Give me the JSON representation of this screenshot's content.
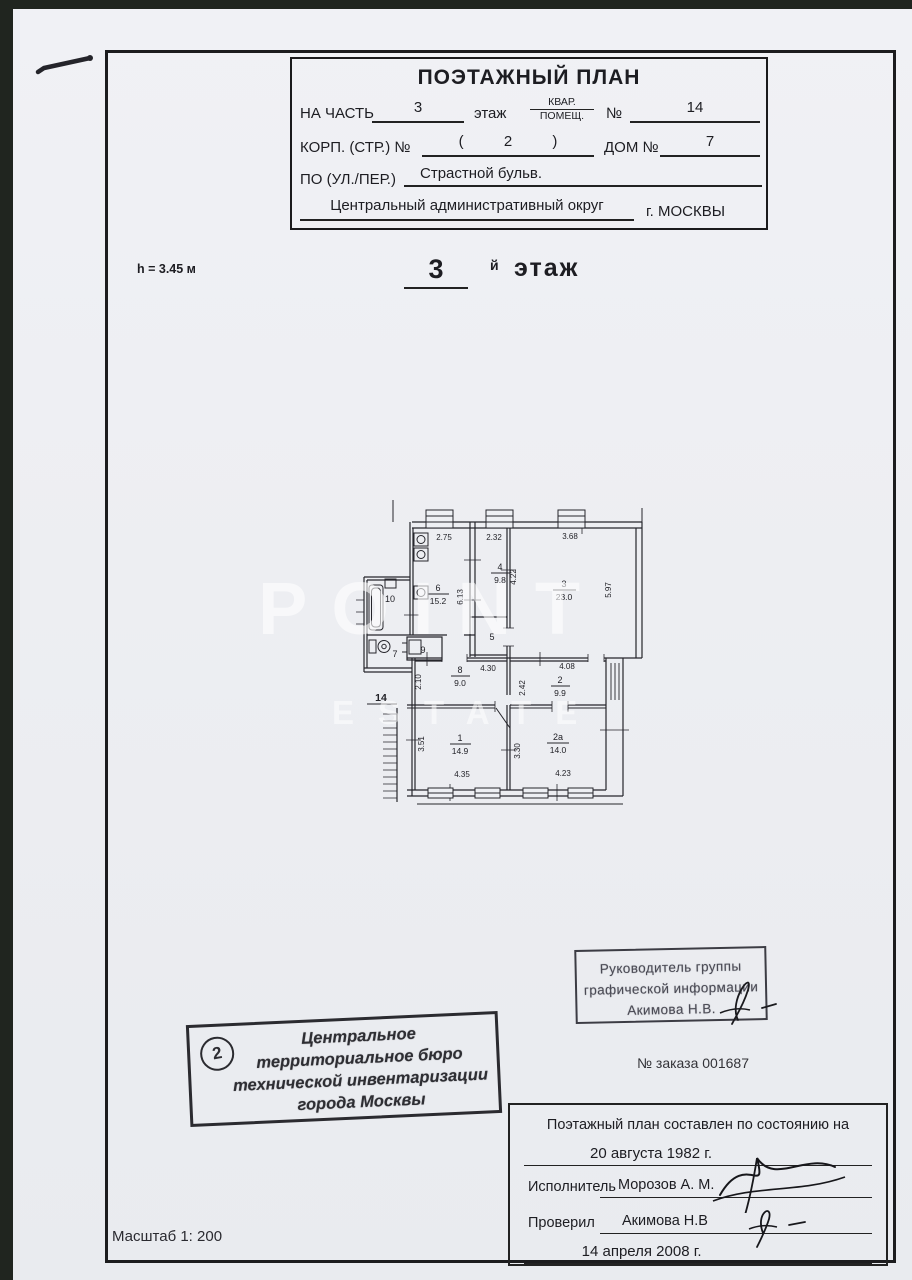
{
  "header": {
    "title": "ПОЭТАЖНЫЙ ПЛАН",
    "na_chast_label": "НА ЧАСТЬ",
    "floor_value": "3",
    "etazh_label": "этаж",
    "kvar_label": "КВАР.",
    "pomesch_label": "ПОМЕЩ.",
    "number_label": "№",
    "apartment_value": "14",
    "korp_label": "КОРП. (СТР.) №",
    "paren_open": "(",
    "korp_value": "2",
    "paren_close": ")",
    "dom_label": "ДОМ №",
    "dom_value": "7",
    "street_label": "ПО (УЛ./ПЕР.)",
    "street_value": "Страстной бульв.",
    "district_value": "Центральный административный округ",
    "city_value": "г. МОСКВЫ"
  },
  "floor_heading": {
    "height_note": "h = 3.45 м",
    "floor_number": "3",
    "floor_suffix": "й",
    "floor_word": "этаж"
  },
  "watermark": {
    "line1": "POINT",
    "line2": "ESTATE"
  },
  "plan": {
    "apartment_number": "14",
    "rooms": {
      "r6": {
        "num": "6",
        "area": "15.2"
      },
      "r4": {
        "num": "4",
        "area": "9.8"
      },
      "r3": {
        "num": "3",
        "area": "23.0"
      },
      "r5": {
        "num": "5"
      },
      "r9": {
        "num": "9"
      },
      "r10": {
        "num": "10"
      },
      "r7": {
        "num": "7"
      },
      "r8": {
        "num": "8",
        "area": "9.0"
      },
      "r2": {
        "num": "2",
        "area": "9.9"
      },
      "r1": {
        "num": "1",
        "area": "14.9"
      },
      "r2a": {
        "num": "2а",
        "area": "14.0"
      }
    },
    "dims": {
      "d275": "2.75",
      "d232": "2.32",
      "d368": "3.68",
      "d613": "6.13",
      "d422": "4.22",
      "d597": "5.97",
      "d430": "4.30",
      "d210": "2.10",
      "d242": "2.42",
      "d408": "4.08",
      "d351": "3.51",
      "d435": "4.35",
      "d330": "3.30",
      "d423": "4.23"
    }
  },
  "stamps": {
    "group_stamp": {
      "line1": "Руководитель группы",
      "line2": "графической информации",
      "line3": "Акимова Н.В."
    },
    "bureau_stamp": {
      "number": "2",
      "line1": "Центральное",
      "line2": "территориальное бюро",
      "line3": "технической инвентаризации",
      "line4": "города Москвы"
    },
    "order_number": "№ заказа 001687"
  },
  "footer_table": {
    "title": "Поэтажный план составлен по состоянию на",
    "date_1982": "20 августа 1982 г.",
    "executor_label": "Исполнитель",
    "executor_name": "Морозов А. М.",
    "checker_label": "Проверил",
    "checker_name": "Акимова Н.В",
    "date_2008": "14 апреля 2008 г."
  },
  "scale_note": "Масштаб 1: 200"
}
